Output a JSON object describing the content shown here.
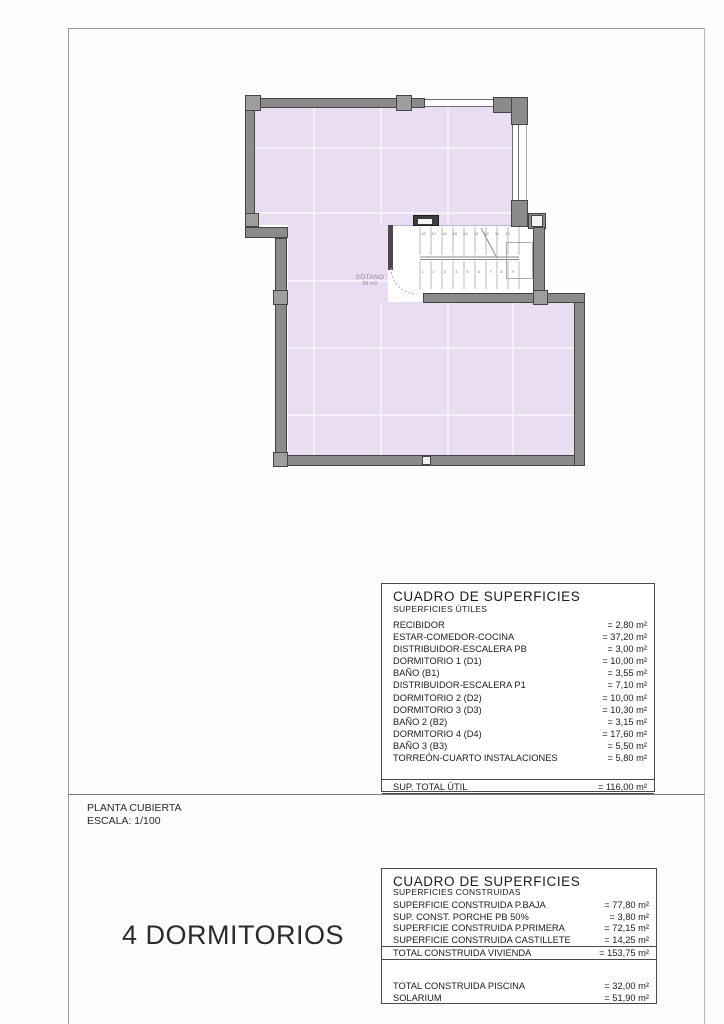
{
  "page": {
    "plan_title": "PLANTA CUBIERTA",
    "plan_scale": "ESCALA: 1/100",
    "bedrooms": "4 DORMITORIOS"
  },
  "plan": {
    "room": {
      "name": "SÓTANO",
      "area": "69 m2"
    },
    "stairs": {
      "upper_steps": "18 17 16 15 14 13 12 11 10",
      "lower_steps": "1 2 3 4 5 6 7 8 9"
    }
  },
  "colors": {
    "roof_fill": "#e9ddf1",
    "roof_grid": "#f5eff8",
    "wall_fill": "#8b8b8b",
    "wall_outline": "#454545"
  },
  "table_utiles": {
    "title": "CUADRO DE SUPERFICIES",
    "subtitle": "SUPERFICIES ÚTILES",
    "rows": [
      {
        "label": "RECIBIDOR",
        "value": "= 2,80 m²"
      },
      {
        "label": "ESTAR-COMEDOR-COCINA",
        "value": "= 37,20 m²"
      },
      {
        "label": "DISTRIBUIDOR-ESCALERA PB",
        "value": "= 3,00 m²"
      },
      {
        "label": "DORMITORIO 1 (D1)",
        "value": "= 10,00 m²"
      },
      {
        "label": "BAÑO (B1)",
        "value": "= 3,55 m²"
      },
      {
        "label": "DISTRIBUIDOR-ESCALERA P1",
        "value": "= 7,10 m²"
      },
      {
        "label": "DORMITORIO 2 (D2)",
        "value": "= 10,00 m²"
      },
      {
        "label": "DORMITORIO 3 (D3)",
        "value": "= 10,30 m²"
      },
      {
        "label": "BAÑO 2 (B2)",
        "value": "= 3,15 m²"
      },
      {
        "label": "DORMITORIO 4 (D4)",
        "value": "= 17,60 m²"
      },
      {
        "label": "BAÑO 3 (B3)",
        "value": "= 5,50 m²"
      },
      {
        "label": "TORREÓN-CUARTO INSTALACIONES",
        "value": "= 5,80 m²"
      }
    ],
    "total": {
      "label": "SUP. TOTAL ÚTIL",
      "value": "= 116,00 m²"
    }
  },
  "table_construidas": {
    "title": "CUADRO DE SUPERFICIES",
    "subtitle": "SUPERFICIES CONSTRUIDAS",
    "rows": [
      {
        "label": "SUPERFICIE CONSTRUIDA P.BAJA",
        "value": "= 77,80 m²"
      },
      {
        "label": "SUP. CONST. PORCHE PB 50%",
        "value": "= 3,80 m²"
      },
      {
        "label": "SUPERFICIE CONSTRUIDA P.PRIMERA",
        "value": "= 72,15 m²"
      },
      {
        "label": "SUPERFICIE CONSTRUIDA CASTILLETE",
        "value": "= 14,25 m²"
      }
    ],
    "total": {
      "label": "TOTAL CONSTRUIDA VIVIENDA",
      "value": "= 153,75 m²"
    },
    "extra_rows": [
      {
        "label": "TOTAL CONSTRUIDA PISCINA",
        "value": "= 32,00 m²"
      },
      {
        "label": "SOLARIUM",
        "value": "= 51,90 m²"
      }
    ]
  }
}
